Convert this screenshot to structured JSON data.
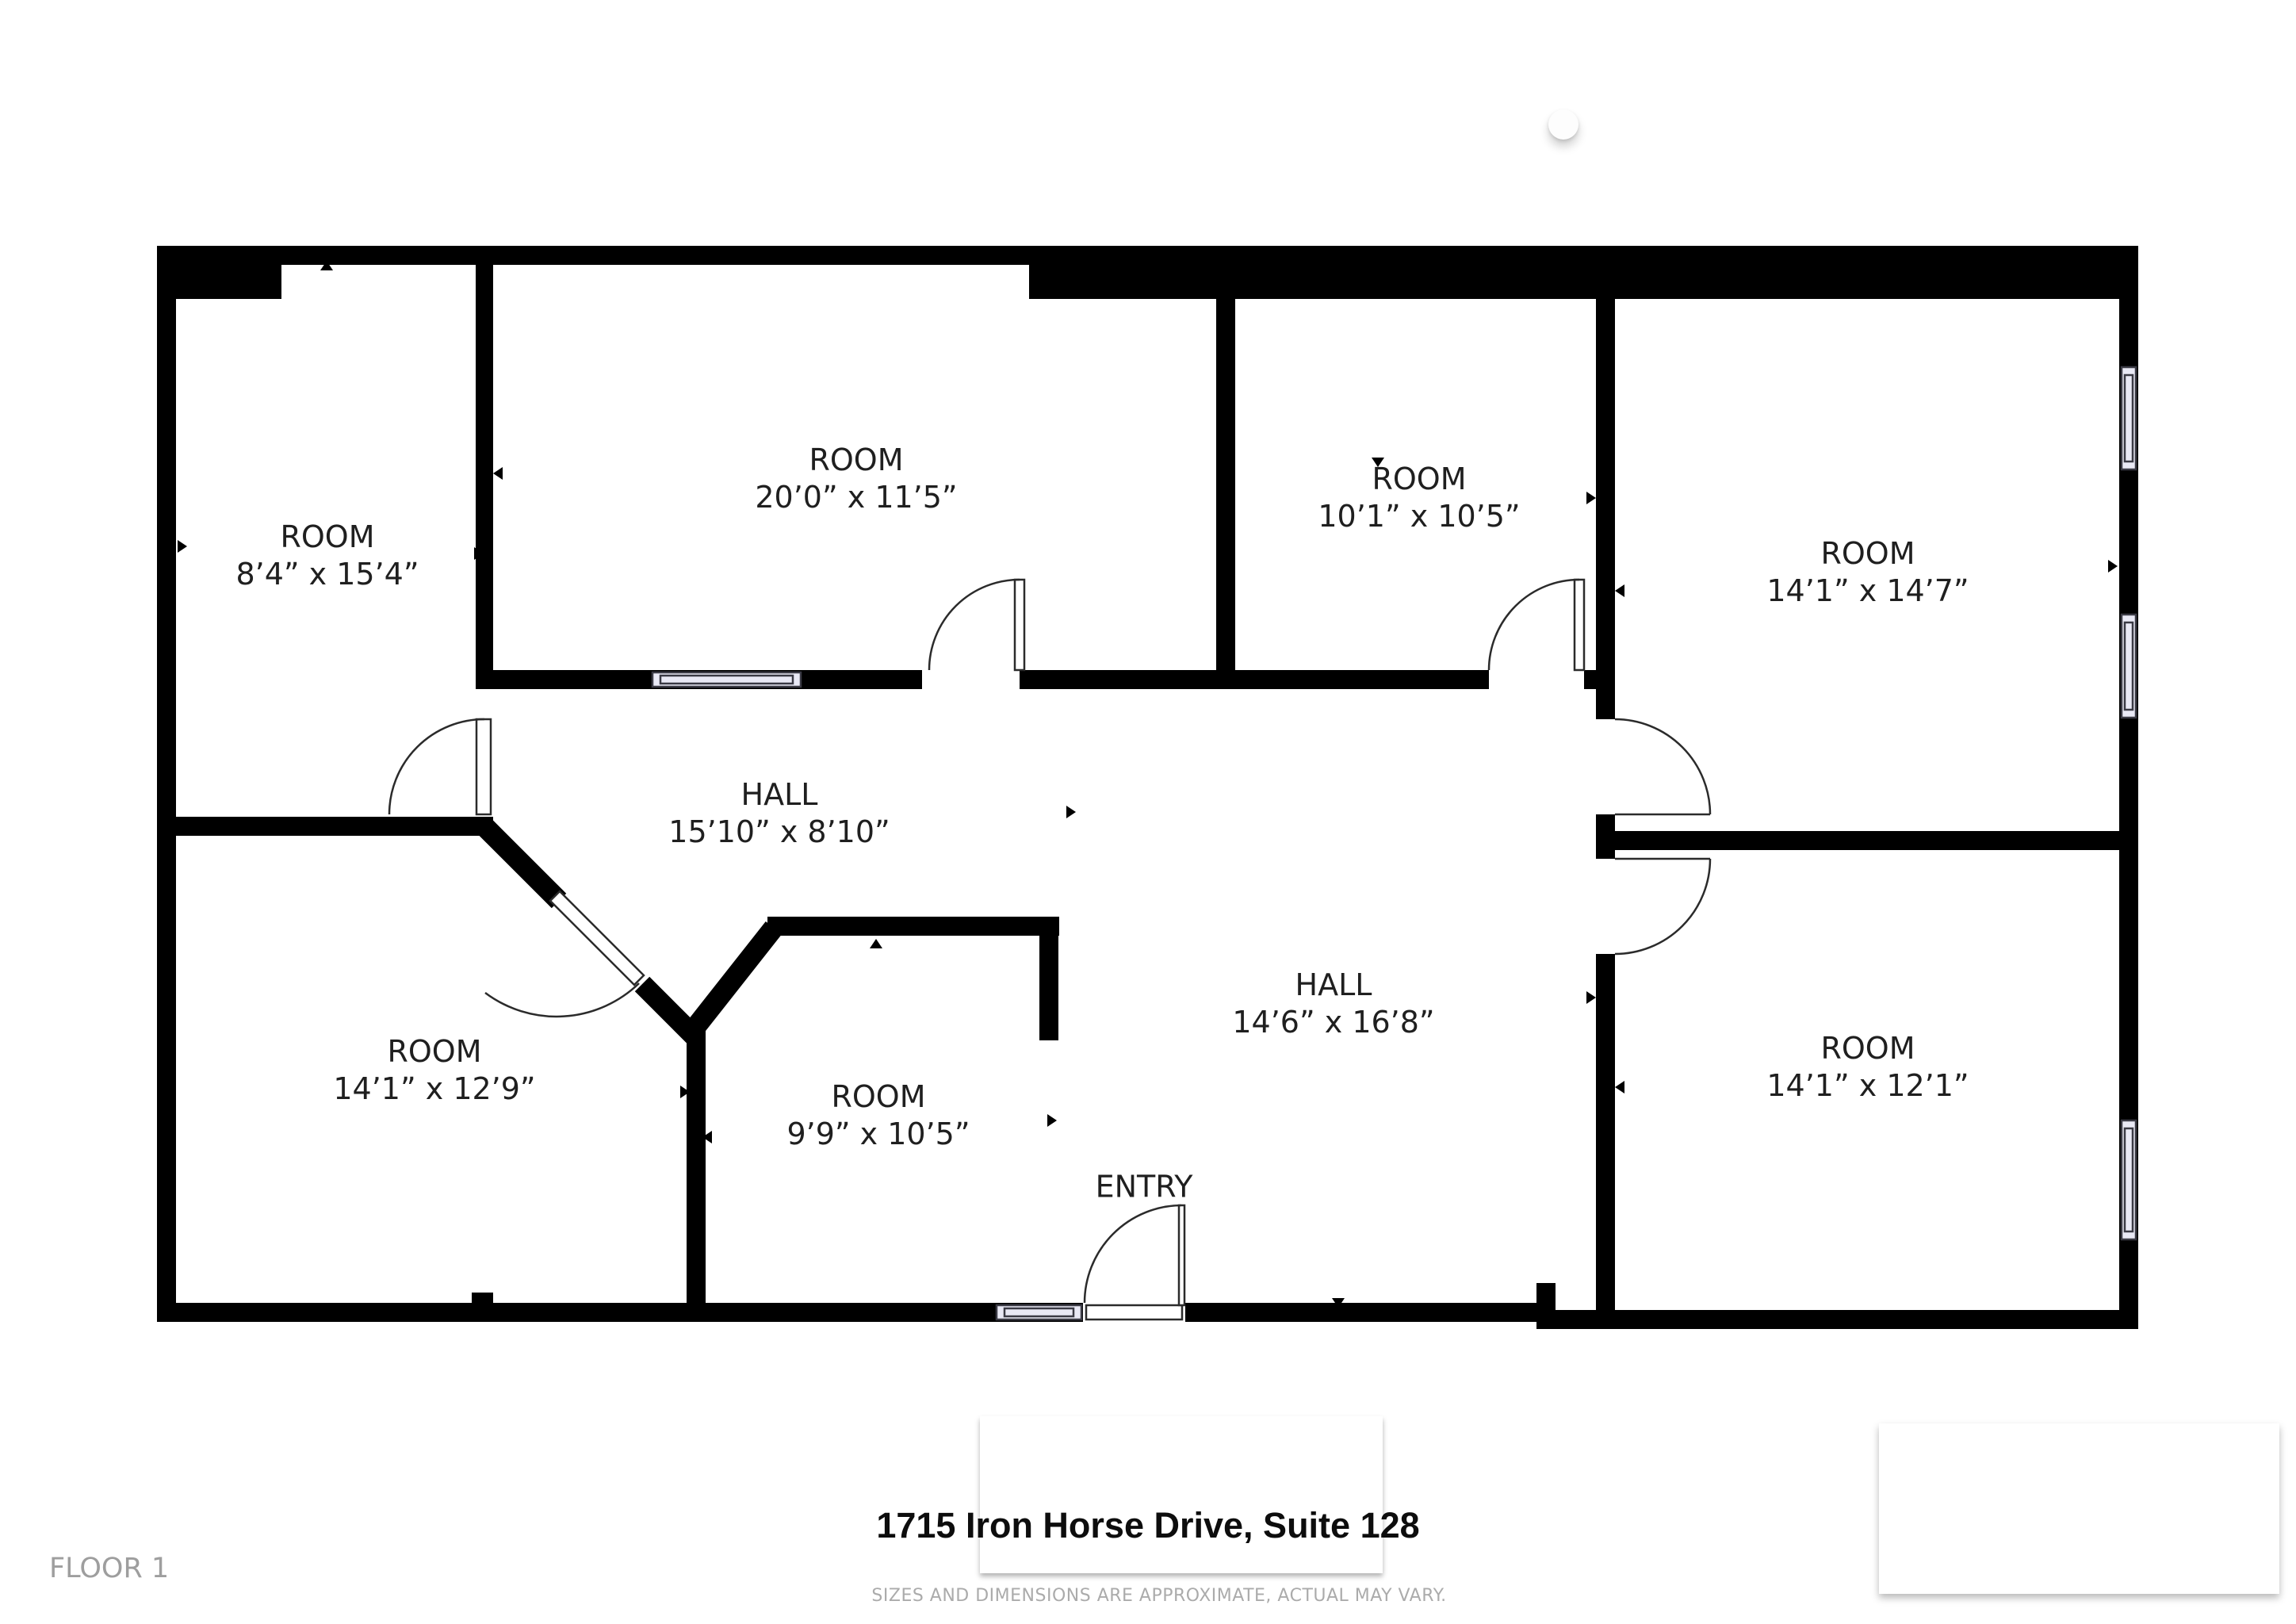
{
  "title_block": {
    "address": "1715 Iron Horse Drive, Suite 128",
    "disclaimer": "SIZES AND DIMENSIONS ARE APPROXIMATE, ACTUAL MAY VARY.",
    "floor_label": "FLOOR 1"
  },
  "rooms": [
    {
      "id": "room-top-left",
      "name": "ROOM",
      "dims": "8’4” x 15’4”"
    },
    {
      "id": "room-top-middle",
      "name": "ROOM",
      "dims": "20’0” x 11’5”"
    },
    {
      "id": "room-top-center",
      "name": "ROOM",
      "dims": "10’1” x 10’5”"
    },
    {
      "id": "room-top-right",
      "name": "ROOM",
      "dims": "14’1” x 14’7”"
    },
    {
      "id": "hall-upper",
      "name": "HALL",
      "dims": "15’10” x 8’10”"
    },
    {
      "id": "hall-lower",
      "name": "HALL",
      "dims": "14’6” x 16’8”"
    },
    {
      "id": "room-bottom-left",
      "name": "ROOM",
      "dims": "14’1” x 12’9”"
    },
    {
      "id": "room-bottom-middle",
      "name": "ROOM",
      "dims": "9’9” x 10’5”"
    },
    {
      "id": "entry",
      "name": "ENTRY",
      "dims": ""
    },
    {
      "id": "room-bottom-right",
      "name": "ROOM",
      "dims": "14’1” x 12’1”"
    }
  ],
  "colors": {
    "wall": "#000000",
    "window_fill": "#e9e9f5",
    "window_stroke": "#3a3a44",
    "door_stroke": "#2b2b2b",
    "label_text": "#1f1f1f",
    "muted_text": "#ababab"
  }
}
